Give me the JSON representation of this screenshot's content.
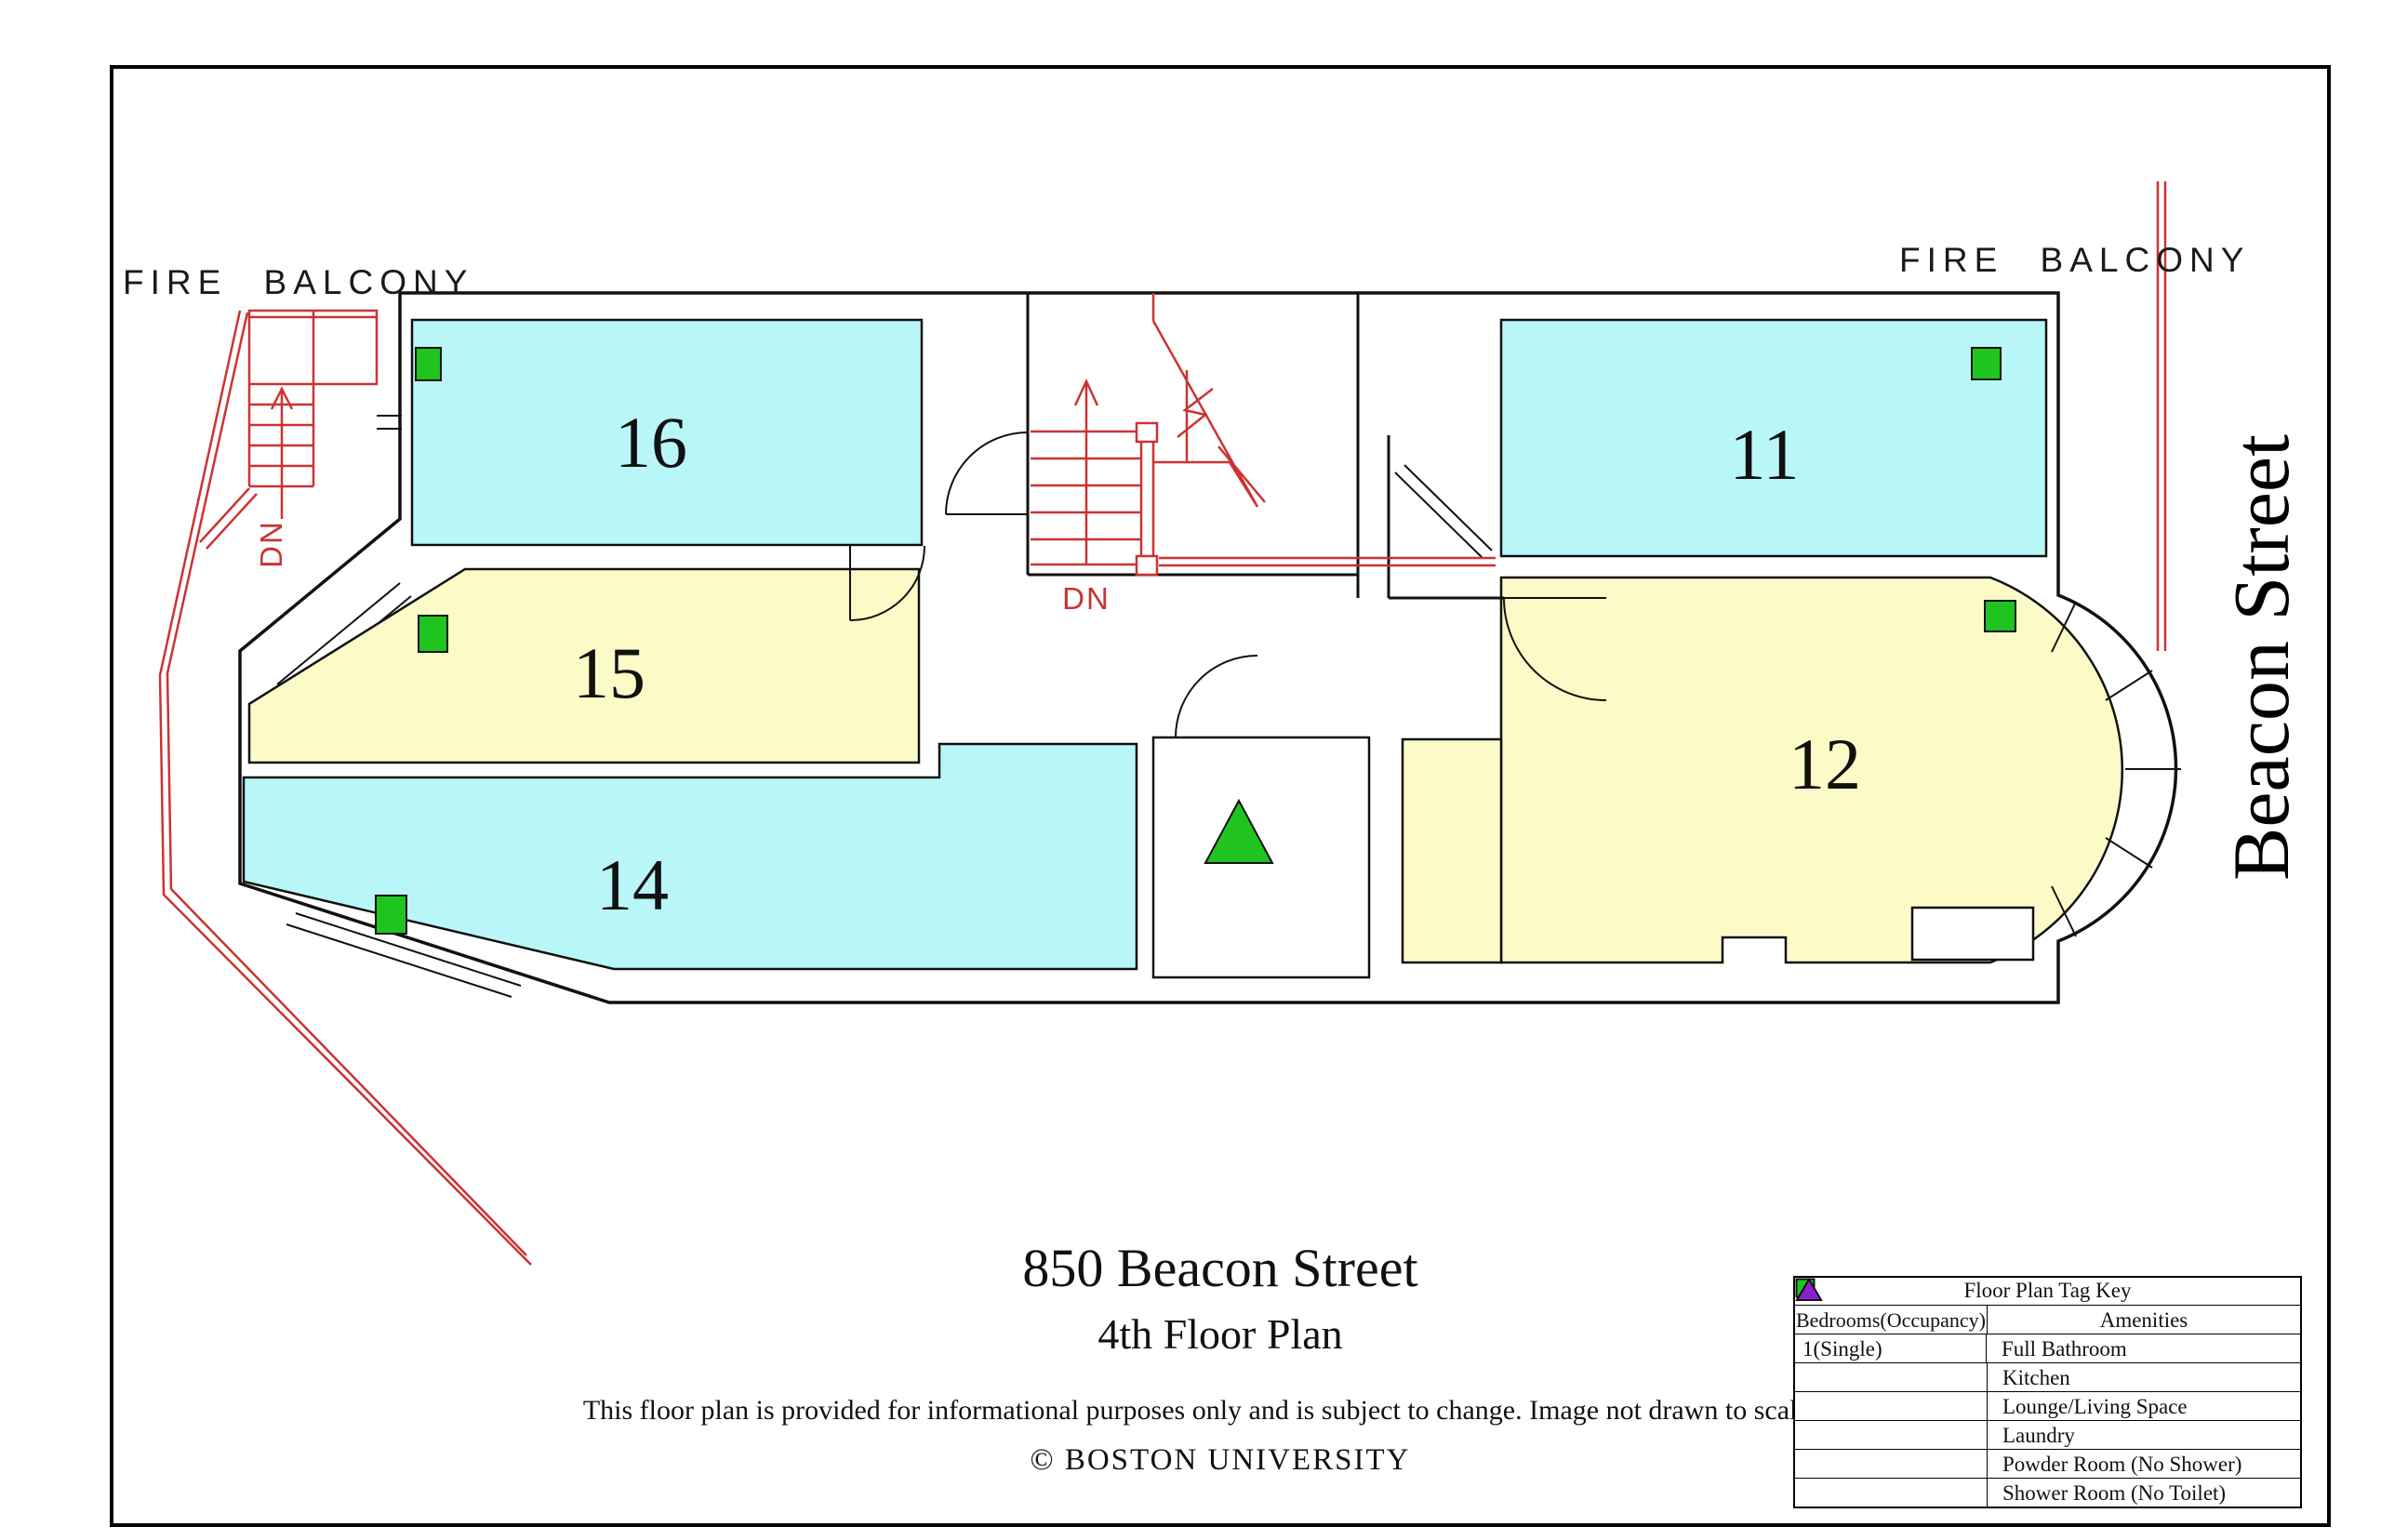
{
  "plan": {
    "labels": {
      "fire_balcony_left": "FIRE BALCONY",
      "fire_balcony_right": "FIRE BALCONY",
      "street": "Beacon Street",
      "stairs_down_left": "DN",
      "stairs_down_center": "DN"
    },
    "rooms": [
      {
        "number": "16",
        "color": "#b9f6f7"
      },
      {
        "number": "15",
        "color": "#fcfac7"
      },
      {
        "number": "14",
        "color": "#b9f6f7"
      },
      {
        "number": "11",
        "color": "#b9f6f7"
      },
      {
        "number": "12",
        "color": "#fcfac7"
      }
    ],
    "tags": {
      "bedroom_single": {
        "shape": "square",
        "color": "#1fc41f"
      },
      "full_bathroom": {
        "shape": "triangle",
        "color": "#1fc41f"
      }
    },
    "line_colors": {
      "walls": "#111111",
      "fire_exit_red": "#cc3333"
    }
  },
  "title_block": {
    "title": "850 Beacon Street",
    "subtitle": "4th Floor Plan",
    "disclaimer": "This floor plan is provided for informational purposes only and is subject to change. Image not drawn to scale.",
    "copyright": "© BOSTON UNIVERSITY"
  },
  "legend": {
    "title": "Floor Plan Tag Key",
    "columns": [
      "Bedrooms(Occupancy)",
      "Amenities"
    ],
    "bedrooms": [
      {
        "label": "1(Single)",
        "color": "#1fc41f"
      }
    ],
    "amenities": [
      {
        "label": "Full Bathroom",
        "color": "#1fc41f"
      },
      {
        "label": "Kitchen",
        "color": "#1b1bd6"
      },
      {
        "label": "Lounge/Living Space",
        "color": "#ec1fec"
      },
      {
        "label": "Laundry",
        "color": "#d41414"
      },
      {
        "label": "Powder Room (No Shower)",
        "color": "#ef8c1a"
      },
      {
        "label": "Shower Room (No Toilet)",
        "color": "#8e1fd0"
      }
    ]
  }
}
